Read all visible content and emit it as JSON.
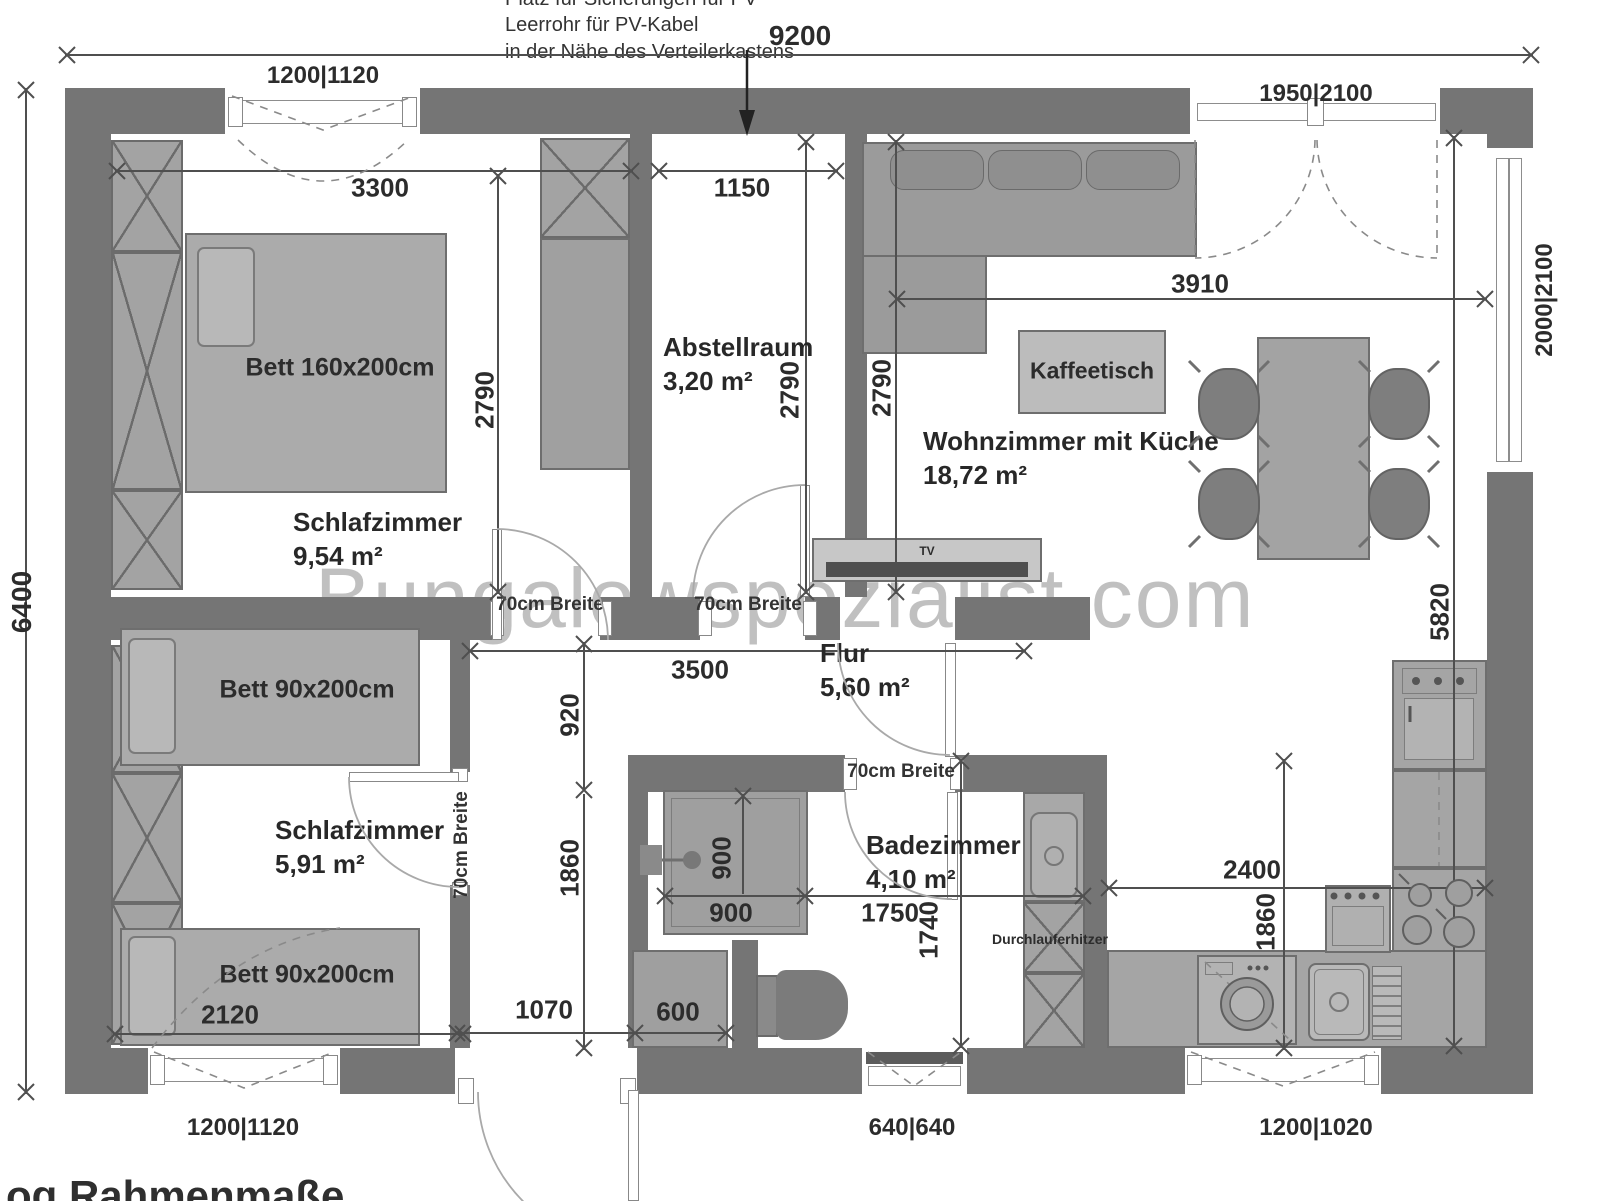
{
  "watermark": "Bungalowspezialist.com",
  "notes": {
    "pv_line1": "Platz für Sicherungen für PV",
    "pv_line2": "Leerrohr für PV-Kabel",
    "pv_line3": "in der Nähe des Verteilerkastens",
    "bottom_note": "og Rahmenmaße"
  },
  "rooms": {
    "bedroom1": {
      "name": "Schlafzimmer",
      "area": "9,54 m²"
    },
    "storage": {
      "name": "Abstellraum",
      "area": "3,20 m²"
    },
    "living": {
      "name": "Wohnzimmer mit Küche",
      "area": "18,72 m²"
    },
    "bedroom2": {
      "name": "Schlafzimmer",
      "area": "5,91 m²"
    },
    "hall": {
      "name": "Flur",
      "area": "5,60 m²"
    },
    "bath": {
      "name": "Badezimmer",
      "area": "4,10 m²"
    }
  },
  "furniture": {
    "bed_double": "Bett 160x200cm",
    "bed_single": "Bett 90x200cm",
    "coffee_table": "Kaffeetisch",
    "tv": "TV",
    "water_heater": "Durchlauferhitzer"
  },
  "labels": {
    "door_width": "70cm Breite"
  },
  "dims": {
    "d9200": "9200",
    "d6400": "6400",
    "d3300": "3300",
    "d1150": "1150",
    "d2790": "2790",
    "d3910": "3910",
    "d5820": "5820",
    "d3500": "3500",
    "d920": "920",
    "d1860": "1860",
    "d900": "900",
    "d1750": "1750",
    "d1740": "1740",
    "d2400": "2400",
    "d2120": "2120",
    "d1070": "1070",
    "d600": "600"
  },
  "openings": {
    "win_1200_1120": "1200|1120",
    "door_1950_2100": "1950|2100",
    "win_2000_2100": "2000|2100",
    "win_640_640": "640|640",
    "win_1200_1020": "1200|1020"
  }
}
